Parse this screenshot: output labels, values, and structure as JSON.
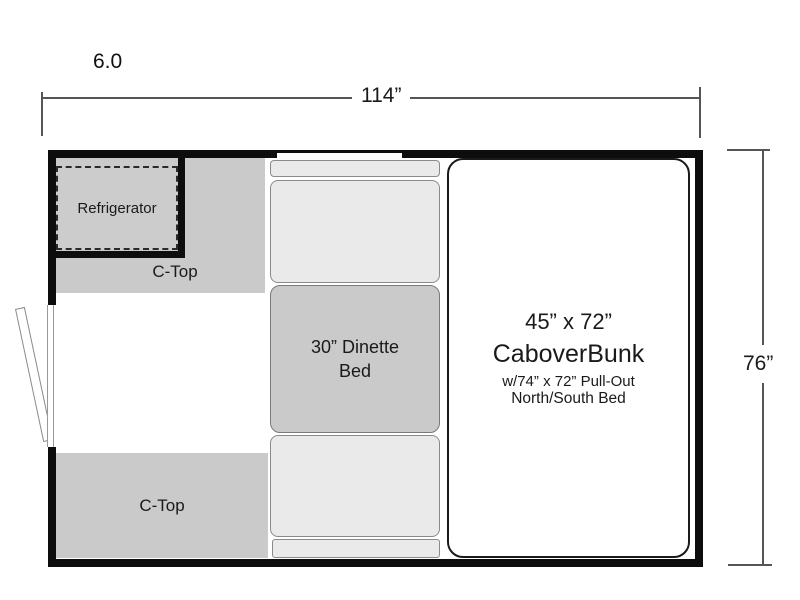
{
  "model_label": "6.0",
  "dimensions": {
    "width_label": "114”",
    "height_label": "76”"
  },
  "fixtures": {
    "refrigerator_label": "Refrigerator",
    "upper_ctop_label": "C-Top",
    "lower_ctop_label": "C-Top",
    "dinette_bed_line1": "30” Dinette",
    "dinette_bed_line2": "Bed",
    "bunk_line1": "45” x 72”",
    "bunk_line2": "CaboverBunk",
    "bunk_line3": "w/74” x 72” Pull-Out",
    "bunk_line4": "North/South Bed"
  },
  "colors": {
    "wall": "#0d0d0d",
    "counter_gray": "#cacaca",
    "seat_gray": "#eaeaea",
    "outline_gray": "#8a8a8a",
    "dimension_line": "#555555",
    "background": "#ffffff"
  }
}
